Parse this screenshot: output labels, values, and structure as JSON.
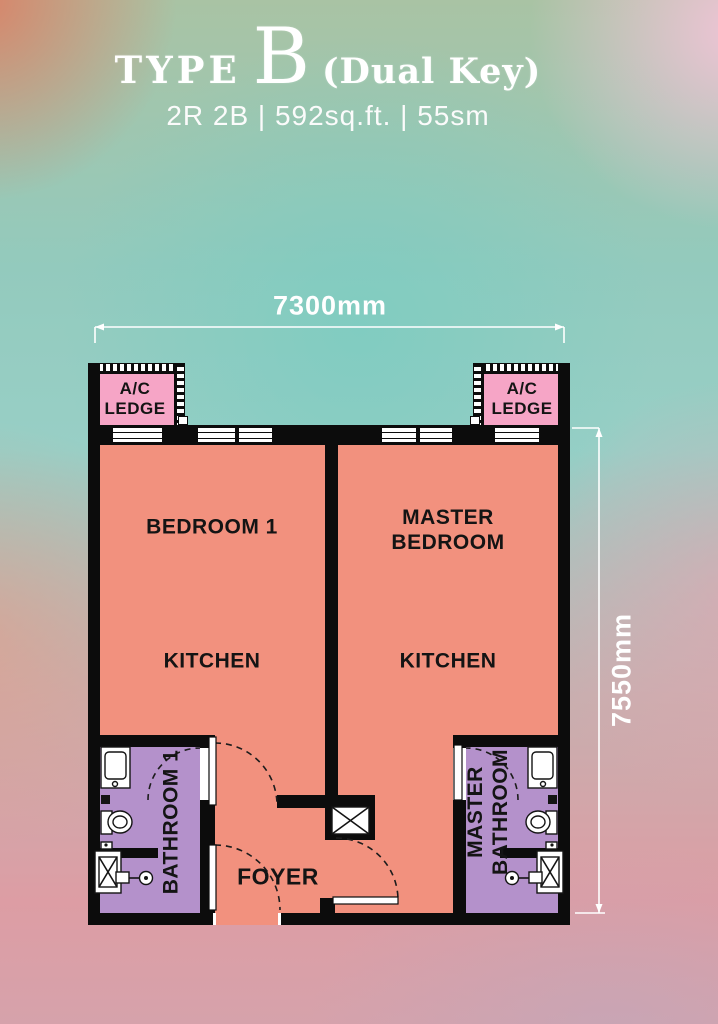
{
  "header": {
    "title_prefix": "TYPE",
    "title_letter": "B",
    "title_suffix": "(Dual Key)",
    "subtitle": "2R 2B | 592sq.ft. | 55sm"
  },
  "dimensions": {
    "width_label": "7300mm",
    "height_label": "7550mm"
  },
  "rooms": {
    "ac_ledge_left": "A/C LEDGE",
    "ac_ledge_right": "A/C LEDGE",
    "bedroom1": "BEDROOM 1",
    "master_bedroom": "MASTER BEDROOM",
    "kitchen_left": "KITCHEN",
    "kitchen_right": "KITCHEN",
    "bathroom1": "BATHROOM 1",
    "master_bathroom": "MASTER BATHROOM",
    "foyer": "FOYER"
  },
  "colors": {
    "wall": "#0c0c0c",
    "room_fill": "#F2917E",
    "bathroom_fill": "#B491CB",
    "ledge_fill": "#F6A5C6",
    "dimension_text": "#FFFFFF",
    "label_text": "#141414"
  }
}
